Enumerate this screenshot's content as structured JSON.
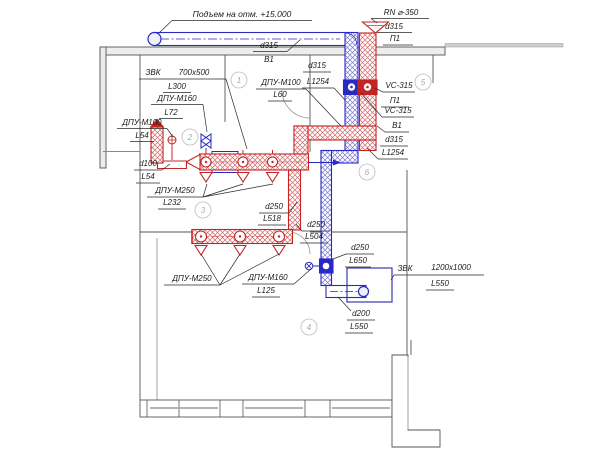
{
  "labels": [
    {
      "t": "Подъем на отм. +15.000"
    },
    {
      "t": "RN ⌀-350"
    },
    {
      "t": "d315"
    },
    {
      "t": "П1"
    },
    {
      "t": "d315"
    },
    {
      "t": "В1"
    },
    {
      "t": "ЗВК"
    },
    {
      "t": "700x500"
    },
    {
      "t": "L300"
    },
    {
      "t": "ДПУ-М160"
    },
    {
      "t": "L72"
    },
    {
      "t": "ДПУ-М100"
    },
    {
      "t": "L54"
    },
    {
      "t": "d100"
    },
    {
      "t": "L54"
    },
    {
      "t": "ДПУ-М250"
    },
    {
      "t": "L232"
    },
    {
      "t": "d250"
    },
    {
      "t": "L518"
    },
    {
      "t": "d250"
    },
    {
      "t": "L504"
    },
    {
      "t": "ДПУ-М250"
    },
    {
      "t": "ДПУ-М160"
    },
    {
      "t": "L125"
    },
    {
      "t": "d250"
    },
    {
      "t": "L650"
    },
    {
      "t": "ЗВК"
    },
    {
      "t": "1200x1000"
    },
    {
      "t": "L550"
    },
    {
      "t": "d200"
    },
    {
      "t": "L550"
    },
    {
      "t": "ДПУ-М100"
    },
    {
      "t": "L60"
    },
    {
      "t": "d315"
    },
    {
      "t": "L1254"
    },
    {
      "t": "VC-315"
    },
    {
      "t": "П1"
    },
    {
      "t": "VC-315"
    },
    {
      "t": "В1"
    },
    {
      "t": "d315"
    },
    {
      "t": "L1254"
    }
  ],
  "room_tags": [
    {
      "n": "1"
    },
    {
      "n": "2"
    },
    {
      "n": "3"
    },
    {
      "n": "4"
    },
    {
      "n": "5"
    },
    {
      "n": "6"
    }
  ],
  "colors": {
    "supply_red": "#c42424",
    "exhaust_blue": "#2929c4",
    "wall_gray": "#555555",
    "annotation_black": "#1b1b1b"
  }
}
